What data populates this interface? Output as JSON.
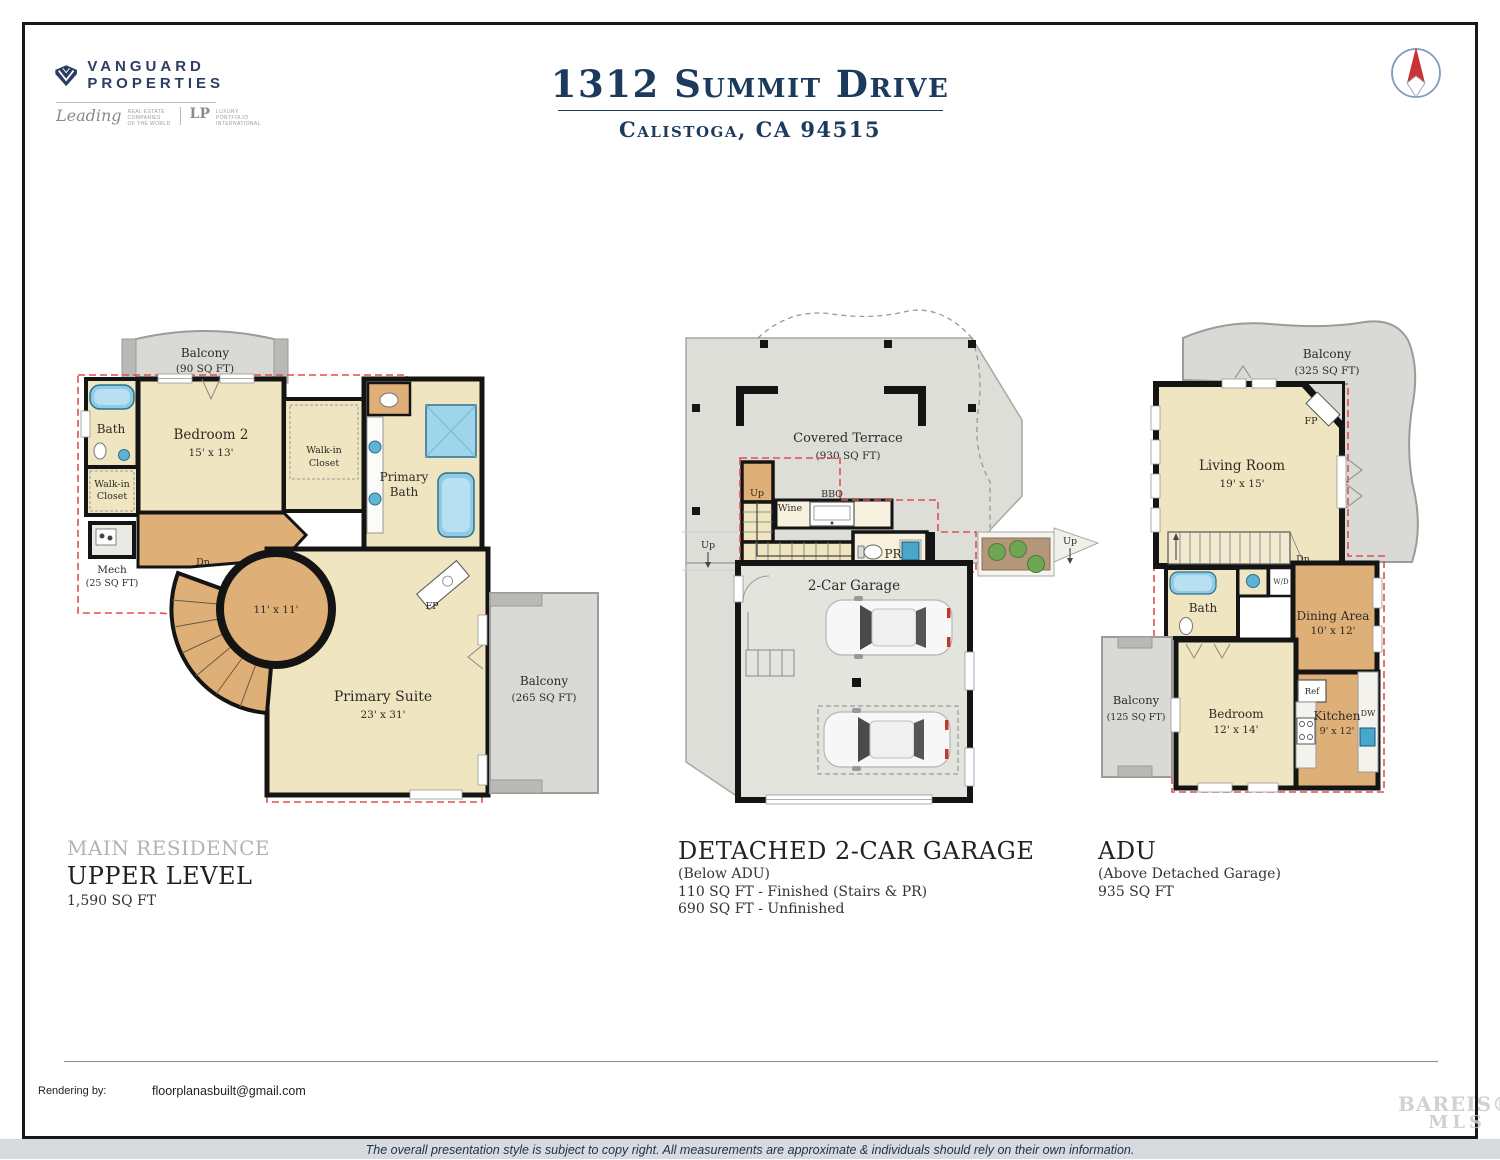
{
  "colors": {
    "navy": "#1b3a5c",
    "brand_navy": "#2b3e62",
    "red_dash": "#e04f4f",
    "floor_beige": "#efe5c1",
    "floor_wood": "#deb077",
    "balcony_gray": "#d9d9d5",
    "terrace_gray": "#deded8",
    "garage_floor": "#e4e4df",
    "wall_black": "#141414",
    "fixture_blue": "#8fcbe4",
    "tree_green": "#6fa653",
    "planter_brown": "#b5967a"
  },
  "header": {
    "brand": {
      "line1": "VANGUARD",
      "line2": "PROPERTIES",
      "script": "Leading",
      "small1": "REAL ESTATE",
      "small2": "COMPANIES",
      "small3": "OF THE WORLD",
      "lp": "LP",
      "lux1": "LUXURY",
      "lux2": "PORTFOLIO",
      "lux3": "INTERNATIONAL"
    },
    "title": "1312 Summit Drive",
    "subtitle": "Calistoga, CA 94515"
  },
  "plan1": {
    "balcony_top": {
      "label": "Balcony",
      "area": "(90 SQ FT)"
    },
    "bath": "Bath",
    "bedroom": {
      "label": "Bedroom 2",
      "dims": "15' x 13'"
    },
    "walkin": {
      "l1": "Walk-in",
      "l2": "Closet"
    },
    "mech": {
      "label": "Mech",
      "area": "(25 SQ FT)"
    },
    "primary_bath": {
      "l1": "Primary",
      "l2": "Bath"
    },
    "dn": "Dn",
    "stair_dims": "11' x 11'",
    "suite": {
      "label": "Primary Suite",
      "dims": "23' x 31'"
    },
    "fp": "FP",
    "balcony_right": {
      "label": "Balcony",
      "area": "(265 SQ FT)"
    },
    "caption": {
      "series": "MAIN RESIDENCE",
      "title": "UPPER LEVEL",
      "area": "1,590 SQ FT"
    }
  },
  "plan2": {
    "terrace": {
      "label": "Covered Terrace",
      "area": "(930 SQ FT)"
    },
    "up": "Up",
    "wine": "Wine",
    "bbq": "BBQ",
    "pr": "PR",
    "garage": "2-Car Garage",
    "caption": {
      "title": "DETACHED 2-CAR GARAGE",
      "sub": "(Below ADU)",
      "line1": "110 SQ FT - Finished (Stairs & PR)",
      "line2": "690 SQ FT - Unfinished"
    }
  },
  "plan3": {
    "balcony_top": {
      "label": "Balcony",
      "area": "(325 SQ FT)"
    },
    "living": {
      "label": "Living Room",
      "dims": "19' x 15'"
    },
    "fp": "FP",
    "dn": "Dn",
    "bath": "Bath",
    "wd": "W/D",
    "dining": {
      "label": "Dining Area",
      "dims": "10' x 12'"
    },
    "balcony_left": {
      "label": "Balcony",
      "area": "(125 SQ FT)"
    },
    "bedroom": {
      "label": "Bedroom",
      "dims": "12' x 14'"
    },
    "kitchen": {
      "label": "Kitchen",
      "dims": "9' x 12'"
    },
    "ref": "Ref",
    "dw": "DW",
    "caption": {
      "title": "ADU",
      "sub": "(Above Detached Garage)",
      "area": "935 SQ FT"
    }
  },
  "footer": {
    "rendering_label": "Rendering by:",
    "rendering_email": "floorplanasbuilt@gmail.com",
    "disclaimer": "The overall presentation style is subject to copy right. All measurements are approximate & individuals should rely on their own information.",
    "watermark_top": "BAREIS®",
    "watermark_bottom": "MLS"
  }
}
